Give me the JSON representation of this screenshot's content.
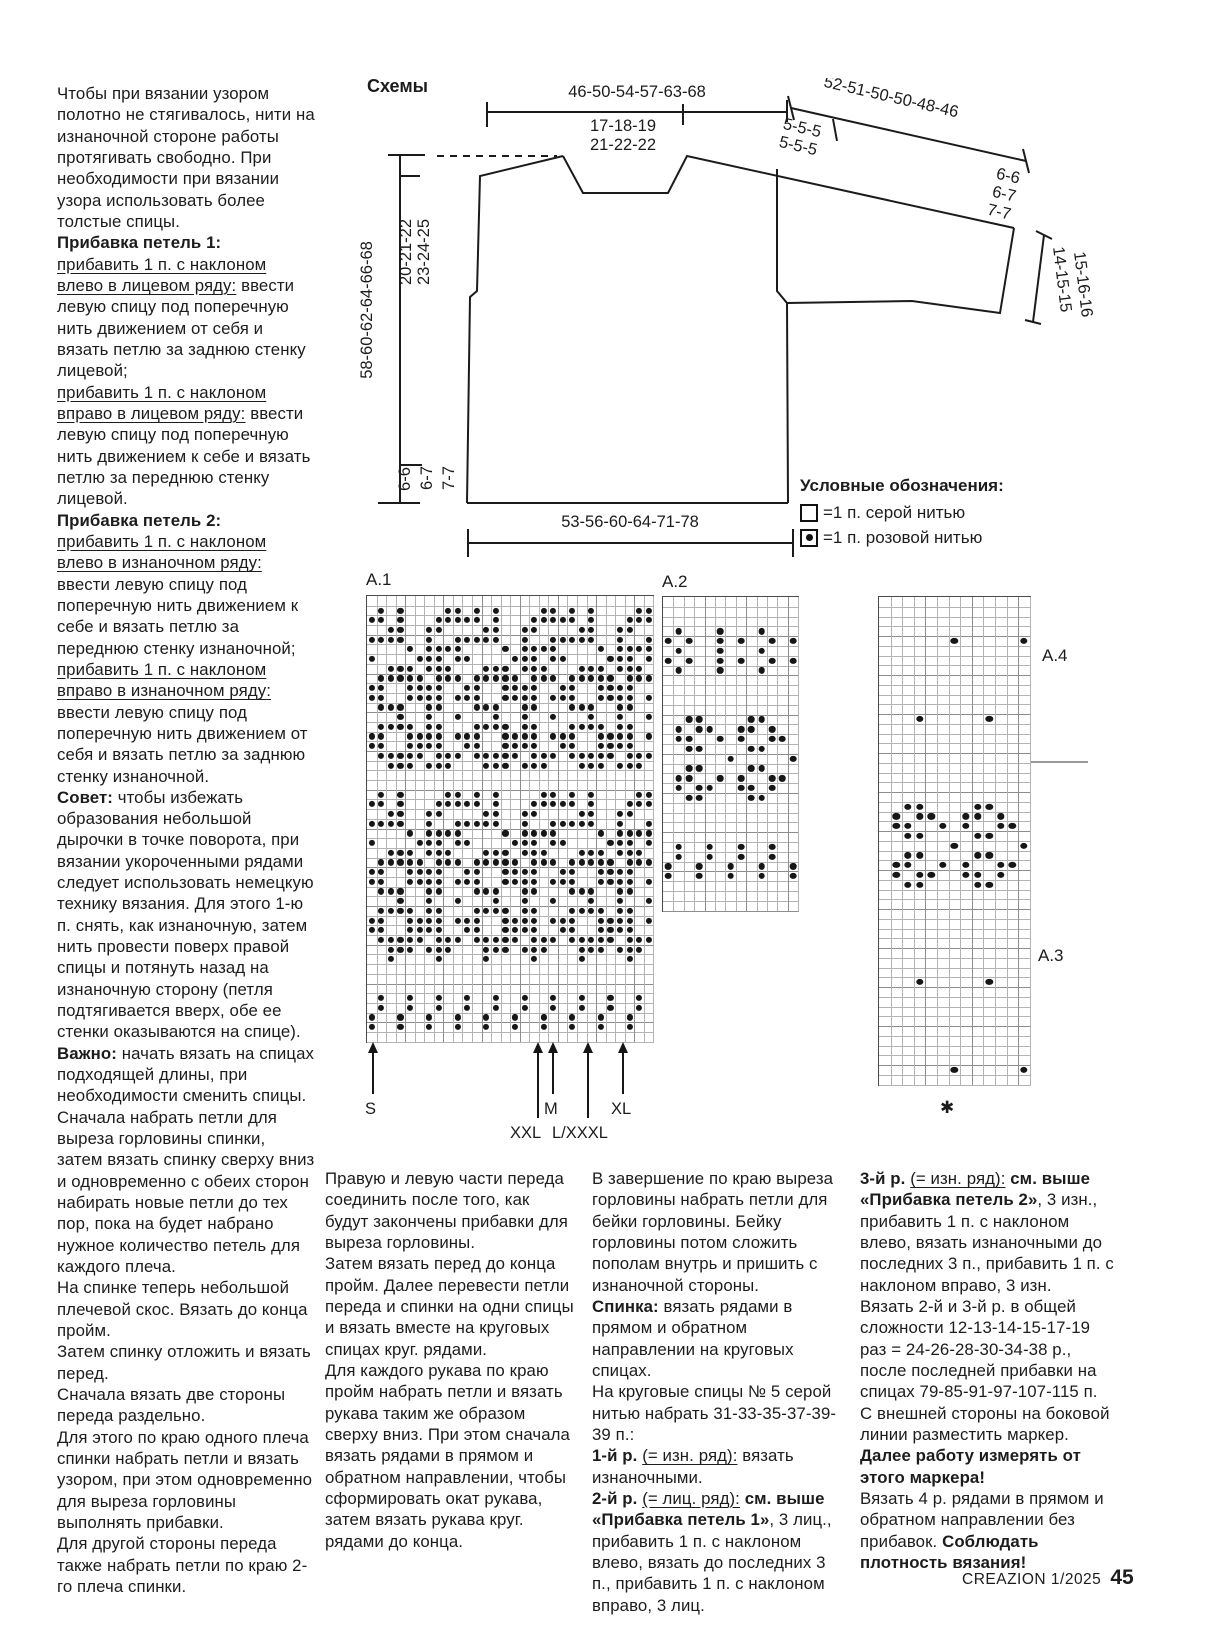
{
  "page": {
    "footer_magazine": "CREAZION 1/2025",
    "footer_page": "45"
  },
  "left_column": [
    [
      {
        "t": "Чтобы при вязании узором полотно не стягивалось, нити на изнаночной стороне работы протягивать свободно. При необходимости при вязании узора использовать более толстые спицы."
      }
    ],
    [
      {
        "t": "Прибавка петель 1:",
        "b": true
      }
    ],
    [
      {
        "t": "прибавить 1 п. с наклоном влево в лицевом ряду:",
        "u": true
      },
      {
        "t": " ввести левую спицу под поперечную нить движением от себя и вязать петлю за заднюю стенку лицевой;"
      }
    ],
    [
      {
        "t": "прибавить 1 п. с наклоном вправо в лицевом ряду:",
        "u": true
      },
      {
        "t": " ввести левую спицу под поперечную нить движением к себе и вязать петлю за переднюю стенку лицевой."
      }
    ],
    [
      {
        "t": "Прибавка петель 2:",
        "b": true
      }
    ],
    [
      {
        "t": "прибавить 1 п. с наклоном влево в изнаночном ряду:",
        "u": true
      },
      {
        "t": " ввести левую спицу под поперечную нить движением к себе и вязать петлю за переднюю стенку изнаночной;"
      }
    ],
    [
      {
        "t": "прибавить 1 п. с наклоном вправо в изнаночном ряду:",
        "u": true
      },
      {
        "t": " ввести левую спицу под поперечную нить движением от себя и вязать петлю за заднюю стенку изнаночной."
      }
    ],
    [
      {
        "t": "Совет:",
        "b": true
      },
      {
        "t": " чтобы избежать образования небольшой дырочки в точке поворота, при вязании укороченными рядами следует использовать немецкую технику вязания. Для этого 1-ю п. снять, как изнаночную, затем нить провести поверх правой спицы и потянуть назад на изнаночную сторону (петля подтягивается вверх, обе ее стенки оказываются на спице)."
      }
    ],
    [
      {
        "t": "Важно:",
        "b": true
      },
      {
        "t": " начать вязать на спицах подходящей длины, при необходимости сменить спицы."
      }
    ],
    [
      {
        "t": "Сначала набрать петли для выреза горловины спинки, затем вязать спинку сверху вниз и одновременно с обеих сторон набирать новые петли до тех пор, пока на будет набрано нужное количество петель для каждого плеча."
      }
    ],
    [
      {
        "t": "На спинке теперь небольшой плечевой скос. Вязать до конца пройм."
      }
    ],
    [
      {
        "t": "Затем спинку отложить и вязать перед."
      }
    ],
    [
      {
        "t": "Сначала вязать две стороны переда раздельно."
      }
    ],
    [
      {
        "t": "Для этого по краю одного плеча спинки набрать петли и вязать узором, при этом одновременно для выреза горловины выполнять прибавки."
      }
    ],
    [
      {
        "t": "Для другой стороны переда также набрать петли по краю 2-го плеча спинки."
      }
    ]
  ],
  "schemes": {
    "title": "Схемы",
    "measurements": {
      "top_width": "46-50-54-57-63-68",
      "neck_width_1": "17-18-19",
      "neck_width_2": "21-22-22",
      "sleeve_top": "52-51-50-50-48-46",
      "sleeve_seg_1": "5-5-5",
      "sleeve_seg_2": "5-5-5",
      "sleeve_rows_1": "6-6",
      "sleeve_rows_2": "6-7",
      "sleeve_rows_3": "7-7",
      "cuff_width_1": "14-15-15",
      "cuff_width_2": "15-16-16",
      "side_length": "58-60-62-64-66-68",
      "yoke_depth_1": "20-21-22",
      "yoke_depth_2": "23-24-25",
      "hem_rows_1": "6-6",
      "hem_rows_2": "6-7",
      "hem_rows_3": "7-7",
      "bottom_width": "53-56-60-64-71-78"
    }
  },
  "legend": {
    "title": "Условные обозначения:",
    "items": [
      {
        "symbol": "white-square",
        "label": "=1 п. серой нитью"
      },
      {
        "symbol": "square-with-dot",
        "label": "=1 п. розовой нитью"
      }
    ]
  },
  "charts": {
    "a1": {
      "label": "A.1",
      "cols": 30,
      "rows": [
        "..............................",
        ".O.O....OO.O.O....OO.O.O....OO",
        "OO.O...OOOOO.O...OOOOO.O...OOO",
        "..OO..OO....OO..OO....OO..OO..",
        "OOOO..O..OOOOO..O..OOOOO..O..O",
        "....O.OOOO....O.OOOO....O.OOOO",
        "O....OOO.OO....OOO.OO....OOO.O",
        "..OOO.OOO...OOO.OOO...OOO.OOO.",
        ".OOOOO.OOO.OOOOO.OOO.OOOOO.OOO",
        "OO..OOOO..OO..OOOO..OO..OOOO..",
        "OO..OOOO.OOO..OOOO.OOO..OOOO.O",
        ".OOO..OO...OOO..OO...OOO..OO..",
        "...O..O..O...O..O..O...O..O..O",
        ".OOOO.OO...OOOO.OO...OOOO.OO..",
        "OO..OOOO.OOO..OOOO.OOO..OOOO.O",
        "OO..OOOO..OO..OOOO..OO..OOOO..",
        ".OOOOO.OOO.OOOOO.OOO.OOOOO.OOO",
        "..OOO.OOO...OOO.OOO...OOO.OOO.",
        "..............................",
        "..............................",
        ".O.O....OO.O.O....OO.O.O....OO",
        "OO.O...OOOOO.O...OOOOO.O...OOO",
        "..OO..OO....OO..OO....OO..OO..",
        "OOOO..O..OOOOO..O..OOOOO..O..O",
        "....O.OOOO....O.OOOO....O.OOOO",
        "O....OOO.OO....OOO.OO....OOO.O",
        "..OOO.OOO...OOO.OOO...OOO.OOO.",
        ".OOOOO.OOO.OOOOO.OOO.OOOOO.OOO",
        "OO..OOOO..OO..OOOO..OO..OOOO..",
        "OO..OOOO.OOO..OOOO.OOO..OOOO.O",
        ".OOO..OO...OOO..OO...OOO..OO..",
        "...O..O..O...O..O..O...O..O..O",
        ".OOOO.OO...OOOO.OO...OOOO.OO..",
        "OO..OOOO.OOO..OOOO.OOO..OOOO.O",
        "OO..OOOO..OO..OOOO..OO..OOOO..",
        ".OOOOO.OOO.OOOOO.OOO.OOOOO.OOO",
        "..OOO.OOO...OOO.OOO...OOO.OOO.",
        "..O....O....O....O....O....O..",
        "..............................",
        "..............................",
        "..............................",
        ".O..O..O..O..O..O..O..O..O..O.",
        ".O..O..O..O..O..O..O..O..O..O.",
        "O..O..O..O..O..O..O..O..O..O..",
        "O..O..O..O..O..O..O..O..O..O..",
        ".............................."
      ]
    },
    "a2": {
      "label": "A.2",
      "cols": 13,
      "rows": [
        ".............",
        ".............",
        ".............",
        ".O...O...O...",
        "O.O..O.O..O.O",
        ".O...O...O...",
        "O.O..O.O..O.O",
        ".O...O...O...",
        ".............",
        ".............",
        ".............",
        ".............",
        "..OO....OO...",
        ".O.OO..OO.O..",
        ".OO..O.O..OO.",
        "..OO....OO...",
        "......O.....O",
        "..OO....OO...",
        ".OO..O.O..OO.",
        ".O.OO..OO.O..",
        "..OO....OO...",
        ".............",
        ".............",
        ".............",
        ".............",
        ".O..O..O..O..",
        ".O..O..O..O..",
        "O..O..O..O..O",
        "O..O..O..O..O",
        ".............",
        ".............",
        "............."
      ]
    },
    "a34": {
      "label_top": "A.4",
      "label_bottom": "A.3",
      "footnote": "✱",
      "cols": 13,
      "rows": [
        ".............",
        ".............",
        ".............",
        ".............",
        "......O.....O",
        ".............",
        ".............",
        ".............",
        ".............",
        ".............",
        ".............",
        ".............",
        "...O.....O...",
        ".............",
        ".............",
        ".............",
        ".............",
        ".............",
        ".............",
        ".............",
        ".............",
        "..OO....OO...",
        ".O.OO..OO.O..",
        ".OO..O.O..OO.",
        "..OO....OO...",
        "......O.....O",
        "..OO....OO...",
        ".OO..O.O..OO.",
        ".O.OO..OO.O..",
        "..OO....OO...",
        ".............",
        ".............",
        ".............",
        ".............",
        ".............",
        ".............",
        ".............",
        ".............",
        ".............",
        "...O.....O...",
        ".............",
        ".............",
        ".............",
        ".............",
        ".............",
        ".............",
        ".............",
        ".............",
        "......O.....O",
        "............."
      ]
    },
    "size_arrows": {
      "s": "S",
      "m": "M",
      "xl": "XL",
      "xxl": "XXL",
      "lxxxl": "L/XXXL"
    }
  },
  "bottom_columns": {
    "col1": [
      [
        {
          "t": "Правую и левую части переда соединить после того, как будут закончены прибавки для выреза горловины."
        }
      ],
      [
        {
          "t": "Затем вязать перед до конца пройм. Далее перевести петли переда и спинки на одни спицы и вязать вместе на круговых спицах круг. рядами."
        }
      ],
      [
        {
          "t": "Для каждого рукава по краю пройм набрать петли и вязать рукава таким же образом сверху вниз. При этом сначала вязать рядами в прямом и обратном направлении, чтобы сформировать окат рукава, затем вязать рукава круг. рядами до конца."
        }
      ]
    ],
    "col2": [
      [
        {
          "t": "В завершение по краю выреза горловины набрать петли для бейки горловины. Бейку горловины потом сложить пополам внутрь и пришить с изнаночной стороны."
        }
      ],
      [
        {
          "t": "Спинка:",
          "b": true
        },
        {
          "t": " вязать рядами в прямом и обратном направлении на круговых спицах."
        }
      ],
      [
        {
          "t": "На круговые спицы № 5 серой нитью набрать 31-33-35-37-39-39 п.:"
        }
      ],
      [
        {
          "t": "1-й р.",
          "b": true
        },
        {
          "t": " "
        },
        {
          "t": "(= изн. ряд):",
          "u": true
        },
        {
          "t": " вязать изнаночными."
        }
      ],
      [
        {
          "t": "2-й р.",
          "b": true
        },
        {
          "t": " "
        },
        {
          "t": "(= лиц. ряд):",
          "u": true
        },
        {
          "t": " "
        },
        {
          "t": "см. выше «Прибавка петель 1»",
          "b": true
        },
        {
          "t": ", 3 лиц., прибавить 1 п. с наклоном влево, вязать до последних 3 п., прибавить 1 п. с наклоном вправо, 3 лиц."
        }
      ]
    ],
    "col3": [
      [
        {
          "t": "3-й р.",
          "b": true
        },
        {
          "t": " "
        },
        {
          "t": "(= изн. ряд):",
          "u": true
        },
        {
          "t": " "
        },
        {
          "t": "см. выше «Прибавка петель 2»",
          "b": true
        },
        {
          "t": ", 3 изн., прибавить 1 п. с наклоном влево, вязать изнаночными до последних 3 п., прибавить 1 п. с наклоном вправо, 3 изн."
        }
      ],
      [
        {
          "t": "Вязать 2-й и 3-й р. в общей сложности 12-13-14-15-17-19 раз = 24-26-28-30-34-38 р., после последней прибавки на спицах 79-85-91-97-107-115 п."
        }
      ],
      [
        {
          "t": "С внешней стороны на боковой линии разместить маркер. "
        },
        {
          "t": "Далее работу измерять от этого маркера!",
          "b": true
        }
      ],
      [
        {
          "t": "Вязать 4 р. рядами в прямом и обратном направлении без прибавок. "
        },
        {
          "t": "Соблюдать плотность вязания!",
          "b": true
        }
      ]
    ]
  }
}
